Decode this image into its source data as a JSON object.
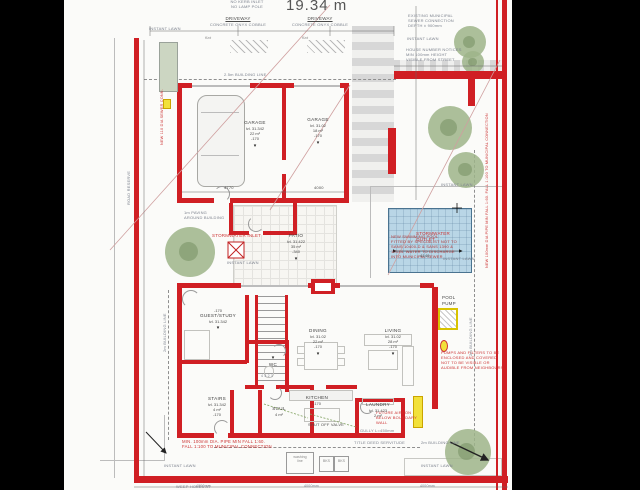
{
  "labels": {
    "total_width": "19.34 m",
    "kerb_note": "NO KERB INLET\nNO LAMP POLE",
    "driveway": "DRIVEWAY",
    "driveway_sub": "CONCRETE ONYX COBBLE",
    "flat": "flat",
    "instant_lawn": "INSTANT LAWN",
    "building_line_25": "2.5m BUILDING LINE",
    "building_line_2": "2m BUILDING LINE",
    "road_reserve": "ROAD RESERVE",
    "washing_line": "washing\nline",
    "bks": "BKS",
    "weep_holes": "WEEP HOLES AT",
    "pool_pump": "POOL\nPUMP",
    "shut_off_valve": "SHUT OFF VALVE",
    "gully": "GULLY   L=450mm",
    "servitude": "TITLE DEED SERVITUDE",
    "stair_numbers": "4 3 2 1"
  },
  "notes": {
    "sewer": "EXISTING MUNICIPAL\nSEWER CONNECTION\nDEPTH ± 900mm",
    "house_number": "HOUSE NUMBER NOTICES\nMIN 100mm HEIGHT\nVISIBLE FROM STREET",
    "stormwater_outlet": "STORMWATER\nOUTLET",
    "stormwater_inlet": "STORMWATER INLET",
    "paving": "1m PAVING\nAROUND BUILDING",
    "pool": "NEW SWIMMING POOL\nFITTED BY SPECIALIST NOT TO\nSANS 10400-D & SANS 1390 &\n10134. WATER TO DISCHARGE\nINTO MUNICIPAL SEWER",
    "pumps": "PUMPS AND FILTERS TO BE\nENCLOSED AND COVERED\nNOT TO BE VISIBLE OR\nAUDIBLE FROM NEIGHBOURS",
    "pipe_bottom": "MIN. 100mm DIA. PIPE MIN FALL 1:60.\nFALL 1:100 TO MUNICIPAL CONNECTION",
    "pipe_right": "NEW 100mm DIA PIPE MIN FALL 1:60. FALL 1:100 TO MUNICIPAL CONNECTION",
    "sewer_conn_left": "NEW 110 DIA SEWER CONN.",
    "future_aircon": "FUTURE AIRCON\nBELOW BOUNDARY\nWALL"
  },
  "dims": {
    "d4770": "4770",
    "d4000": "4000",
    "pool": "4149",
    "bottom": "4000mm"
  },
  "rooms": [
    {
      "name": "GARAGE",
      "level": "lvl. 31.342",
      "area": "22 m²",
      "offset": "-170"
    },
    {
      "name": "GARAGE",
      "level": "lvl. 31.02",
      "area": "18 m²",
      "offset": "-170"
    },
    {
      "name": "PATIO",
      "level": "lvl. 31.422",
      "area": "35 m²",
      "offset": "-340"
    },
    {
      "name": "GUEST/STUDY",
      "level": "lvl. 31.342",
      "offset": "-170"
    },
    {
      "name": "WC"
    },
    {
      "name": "STAIRS",
      "level": "lvl. 31.342",
      "area": "4 m²",
      "offset": "-170"
    },
    {
      "name": "SCUL",
      "area": "4 m²"
    },
    {
      "name": "KITCHEN",
      "offset": "-170"
    },
    {
      "name": "DINING",
      "level": "lvl. 31.02",
      "area": "22 m²",
      "offset": "-170"
    },
    {
      "name": "LIVING",
      "level": "lvl. 31.02",
      "area": "28 m²",
      "offset": "-170"
    },
    {
      "name": "LAUNDRY",
      "level": "lvl. 31.423",
      "area": "2 m²",
      "offset": "-340"
    }
  ],
  "colors": {
    "wall_red": "#d01f24",
    "note_red": "#cc3333",
    "pool_fill": "#b9d6e6",
    "tree_green": "#9db489",
    "highlight_yellow": "#f2e13a"
  }
}
